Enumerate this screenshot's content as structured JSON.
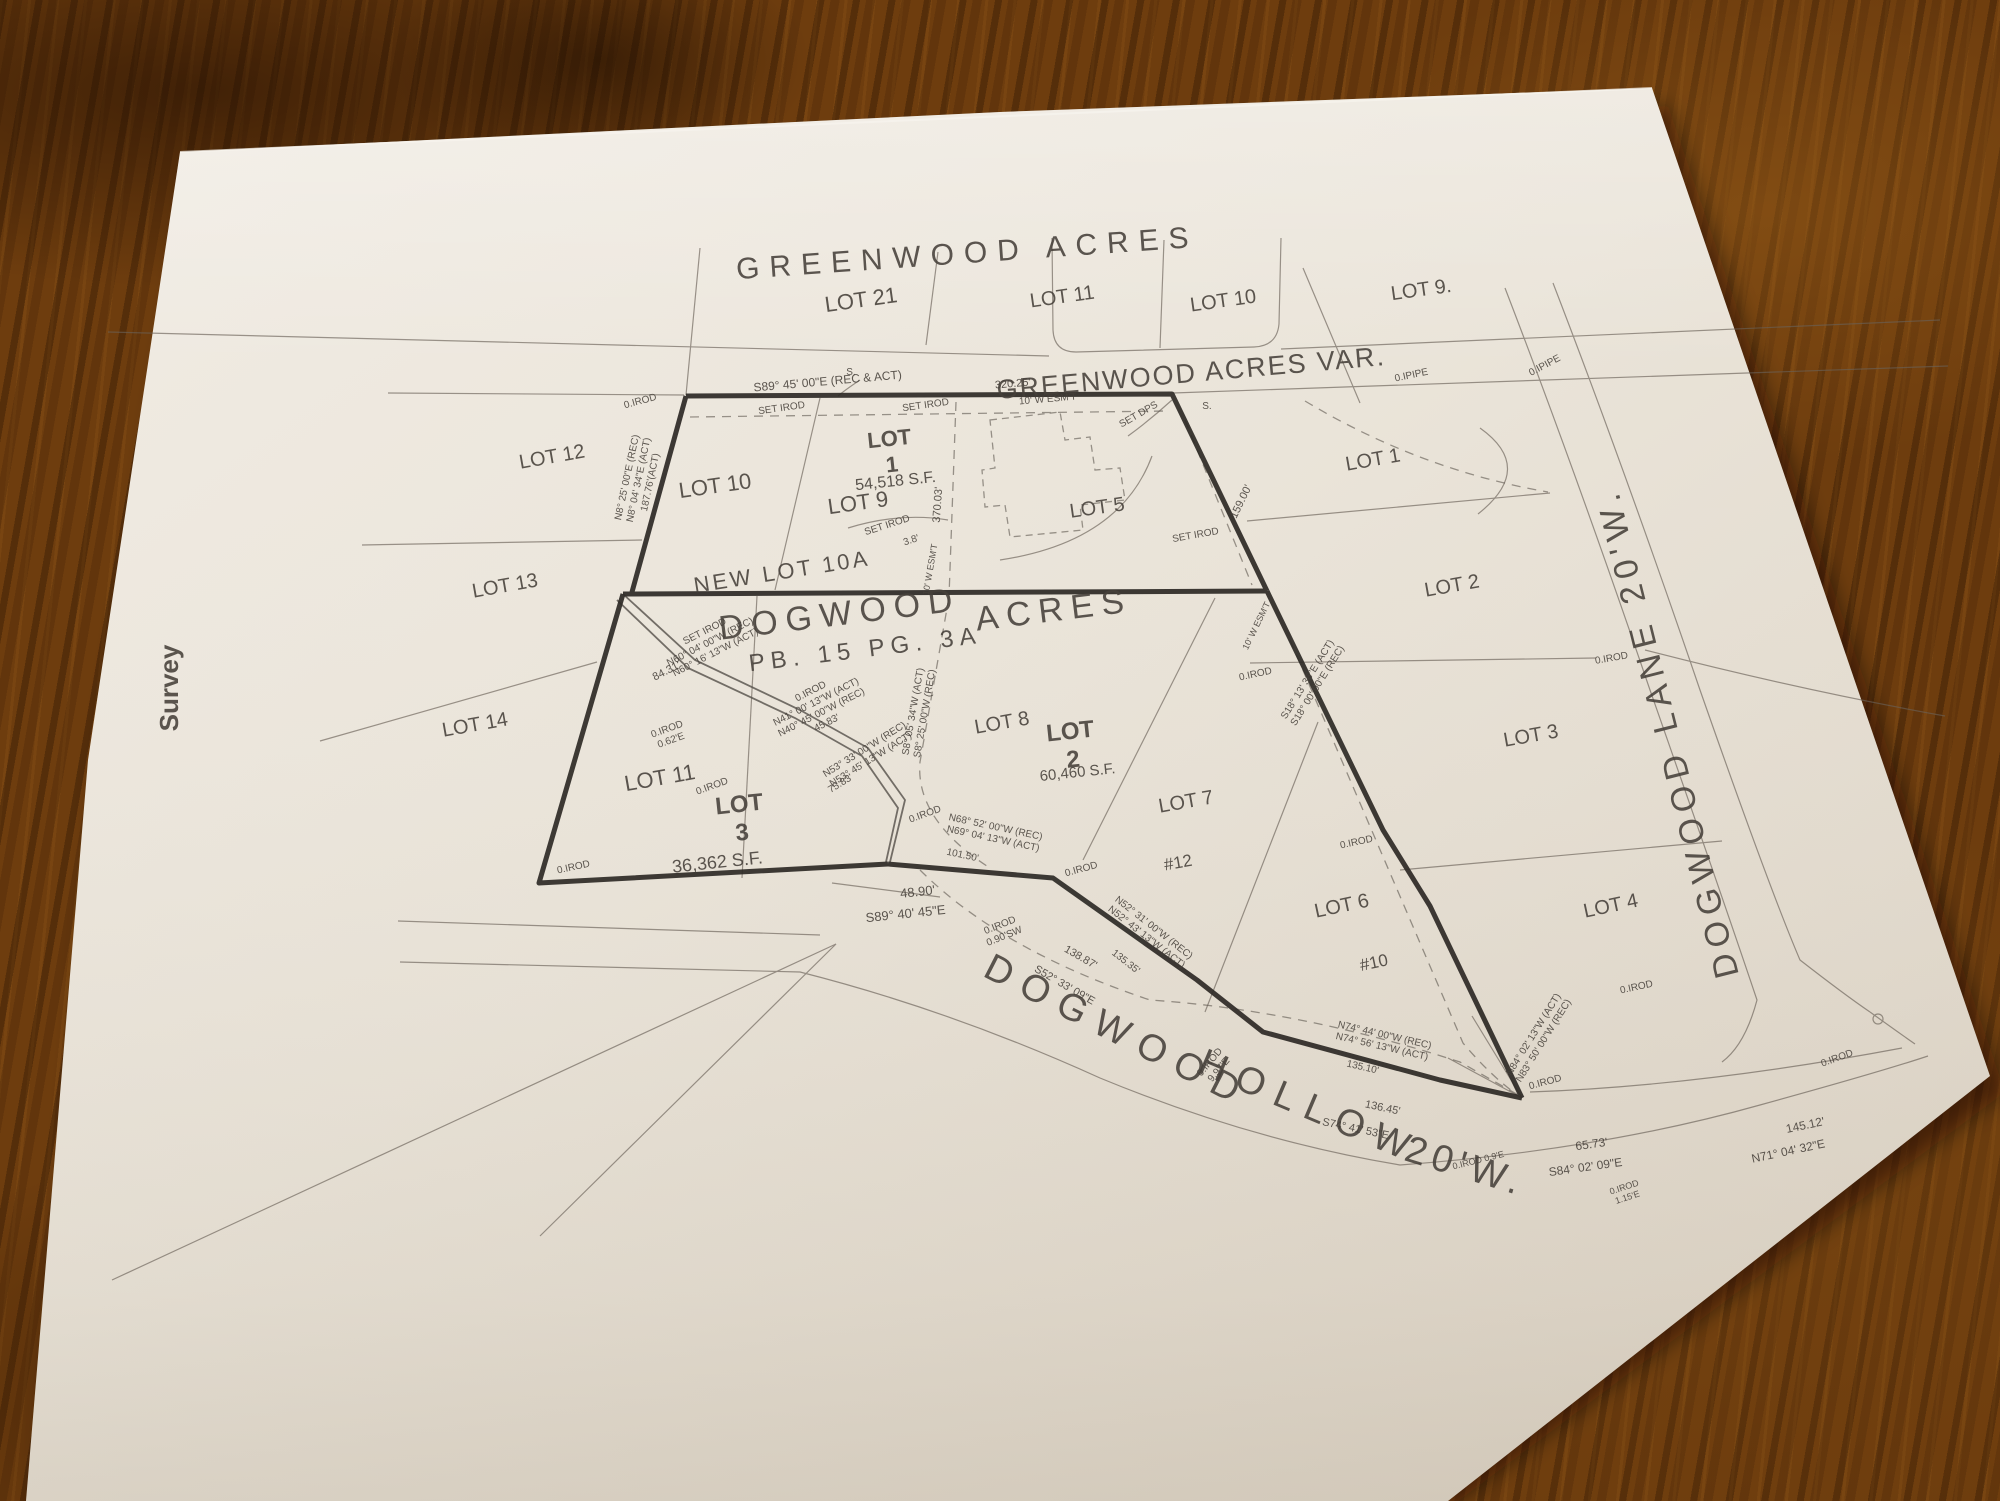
{
  "document_type": "survey plat photograph",
  "colors": {
    "paper": "#ece6db",
    "paper_shade": "#d9d1c4",
    "ink_thick": "#2e2a26",
    "ink_medium": "#55504a",
    "ink_thin": "#6a6158",
    "wood_dark": "#3f2306",
    "wood_mid": "#6e3d0e",
    "wood_light": "#93601c"
  },
  "titles": {
    "subdivision_top": "GREENWOOD ACRES",
    "subdivision_var": "GREENWOOD ACRES VAR.",
    "subdivision_main_1": "DOGWOOD",
    "subdivision_main_2": "ACRES",
    "plat_book": "PB. 15 PG. 3A",
    "sheet_tab": "Survey",
    "road_east": "DOGWOOD  LANE  20'W.",
    "road_south_1": "DOGWOOD",
    "road_south_2": "HOLLOW",
    "road_south_3": "20'W."
  },
  "labels": [
    {
      "name": "title-greenwood-acres",
      "text": "GREENWOOD   ACRES",
      "x": 968,
      "y": 263,
      "rot": -4,
      "size": 30,
      "ls": 10,
      "w": 500,
      "fill": "#3b362f"
    },
    {
      "name": "title-greenwood-var",
      "text": "GREENWOOD ACRES VAR.",
      "x": 1192,
      "y": 382,
      "rot": -5,
      "size": 27,
      "ls": 2,
      "w": 500,
      "fill": "#3b362f"
    },
    {
      "name": "title-dogwood",
      "text": "DOGWOOD",
      "x": 841,
      "y": 625,
      "rot": -7,
      "size": 34,
      "ls": 8,
      "w": 500,
      "fill": "#35302a"
    },
    {
      "name": "title-acres",
      "text": "ACRES",
      "x": 1055,
      "y": 621,
      "rot": -7,
      "size": 34,
      "ls": 8,
      "w": 500,
      "fill": "#35302a"
    },
    {
      "name": "label-plat-book",
      "text": "PB. 15 PG. 3A",
      "x": 866,
      "y": 657,
      "rot": -7,
      "size": 24,
      "ls": 6,
      "fill": "#413b33"
    },
    {
      "name": "label-new-lot-10a",
      "text": "NEW LOT 10A",
      "x": 783,
      "y": 579,
      "rot": -9,
      "size": 22,
      "ls": 3
    },
    {
      "name": "label-survey-tab",
      "text": "Survey",
      "x": 178,
      "y": 688,
      "rot": -90,
      "size": 26,
      "w": 700,
      "fill": "#1d1b18"
    },
    {
      "name": "label-dogwood-lane",
      "text": "DOGWOOD  LANE  20'W.",
      "x": 1678,
      "y": 730,
      "rot": -104,
      "size": 34,
      "ls": 7,
      "fill": "#3b362f"
    },
    {
      "name": "label-hollow-1",
      "text": "DOGWOOD",
      "x": 1112,
      "y": 1042,
      "rot": 27,
      "size": 38,
      "ls": 12,
      "fill": "#3b362f"
    },
    {
      "name": "label-hollow-2",
      "text": "HOLLOW",
      "x": 1305,
      "y": 1118,
      "rot": 23,
      "size": 38,
      "ls": 12,
      "fill": "#3b362f"
    },
    {
      "name": "label-hollow-3",
      "text": "20'W.",
      "x": 1462,
      "y": 1178,
      "rot": 17,
      "size": 38,
      "ls": 6,
      "fill": "#3b362f"
    },
    {
      "name": "label-lot-21",
      "text": "LOT 21",
      "x": 862,
      "y": 307,
      "rot": -8,
      "size": 22
    },
    {
      "name": "label-lot-11-top",
      "text": "LOT 11",
      "x": 1063,
      "y": 303,
      "rot": -8,
      "size": 20
    },
    {
      "name": "label-lot-10-top",
      "text": "LOT 10",
      "x": 1224,
      "y": 307,
      "rot": -8,
      "size": 20
    },
    {
      "name": "label-lot-9-top",
      "text": "LOT 9.",
      "x": 1422,
      "y": 296,
      "rot": -8,
      "size": 20
    },
    {
      "name": "label-lot-1-east",
      "text": "LOT 1",
      "x": 1374,
      "y": 466,
      "rot": -10,
      "size": 20
    },
    {
      "name": "label-lot-2-east",
      "text": "LOT 2",
      "x": 1453,
      "y": 592,
      "rot": -10,
      "size": 20
    },
    {
      "name": "label-lot-3-east",
      "text": "LOT 3",
      "x": 1532,
      "y": 742,
      "rot": -10,
      "size": 20
    },
    {
      "name": "label-lot-4-east",
      "text": "LOT 4",
      "x": 1612,
      "y": 912,
      "rot": -12,
      "size": 20
    },
    {
      "name": "label-lot-12",
      "text": "LOT 12",
      "x": 553,
      "y": 463,
      "rot": -10,
      "size": 20
    },
    {
      "name": "label-lot-13",
      "text": "LOT 13",
      "x": 506,
      "y": 592,
      "rot": -10,
      "size": 20
    },
    {
      "name": "label-lot-14",
      "text": "LOT 14",
      "x": 476,
      "y": 731,
      "rot": -10,
      "size": 20
    },
    {
      "name": "label-lot-10-block",
      "text": "LOT 10",
      "x": 716,
      "y": 493,
      "rot": -8,
      "size": 22
    },
    {
      "name": "label-lot-9-block",
      "text": "LOT 9",
      "x": 859,
      "y": 510,
      "rot": -8,
      "size": 22
    },
    {
      "name": "label-lot-1-stack",
      "lines": [
        "LOT",
        "1"
      ],
      "x": 890,
      "y": 446,
      "rot": -6,
      "size": 22,
      "w": 600,
      "fill": "#3b362f"
    },
    {
      "name": "label-lot-1-area",
      "text": "54,518 S.F.",
      "x": 896,
      "y": 486,
      "rot": -6,
      "size": 16
    },
    {
      "name": "label-lot-5",
      "text": "LOT 5",
      "x": 1098,
      "y": 514,
      "rot": -8,
      "size": 20
    },
    {
      "name": "label-lot-11-block",
      "text": "LOT 11",
      "x": 661,
      "y": 785,
      "rot": -10,
      "size": 22
    },
    {
      "name": "label-lot-3-stack",
      "lines": [
        "LOT",
        "3"
      ],
      "x": 740,
      "y": 812,
      "rot": -6,
      "size": 24,
      "w": 600,
      "fill": "#35302a"
    },
    {
      "name": "label-lot-3-area",
      "text": "36,362 S.F.",
      "x": 718,
      "y": 868,
      "rot": -6,
      "size": 18,
      "fill": "#3b362f"
    },
    {
      "name": "label-lot-8",
      "text": "LOT 8",
      "x": 1003,
      "y": 729,
      "rot": -10,
      "size": 20
    },
    {
      "name": "label-lot-2-stack",
      "lines": [
        "LOT",
        "2"
      ],
      "x": 1071,
      "y": 739,
      "rot": -6,
      "size": 24,
      "w": 600,
      "fill": "#35302a"
    },
    {
      "name": "label-lot-2-area",
      "text": "60,460 S.F.",
      "x": 1078,
      "y": 777,
      "rot": -6,
      "size": 15
    },
    {
      "name": "label-lot-7",
      "text": "LOT 7",
      "x": 1187,
      "y": 808,
      "rot": -10,
      "size": 20
    },
    {
      "name": "label-hash-12",
      "text": "#12",
      "x": 1179,
      "y": 868,
      "rot": -10,
      "size": 17
    },
    {
      "name": "label-lot-6",
      "text": "LOT 6",
      "x": 1343,
      "y": 912,
      "rot": -12,
      "size": 20
    },
    {
      "name": "label-hash-10",
      "text": "#10",
      "x": 1375,
      "y": 968,
      "rot": -12,
      "size": 17
    },
    {
      "name": "dim-s89-top",
      "text": "S89° 45' 00\"E (REC & ACT)",
      "x": 828,
      "y": 385,
      "rot": -5,
      "size": 12
    },
    {
      "name": "dim-320-25",
      "text": "320.25'",
      "x": 1013,
      "y": 387,
      "rot": -5,
      "size": 11
    },
    {
      "name": "dim-esmt-top",
      "text": "10' W ESM'T",
      "x": 1048,
      "y": 402,
      "rot": -5,
      "size": 10
    },
    {
      "name": "marker-set-irod-1",
      "text": "SET IROD",
      "x": 782,
      "y": 411,
      "rot": -8,
      "size": 10
    },
    {
      "name": "marker-set-irod-2",
      "text": "SET IROD",
      "x": 926,
      "y": 408,
      "rot": -8,
      "size": 10
    },
    {
      "name": "marker-set-dps",
      "text": "SET DPS",
      "x": 1140,
      "y": 417,
      "rot": -30,
      "size": 10
    },
    {
      "name": "marker-s-1",
      "text": "S.",
      "x": 851,
      "y": 375,
      "rot": 0,
      "size": 10
    },
    {
      "name": "marker-s-2",
      "text": "S.",
      "x": 1207,
      "y": 409,
      "rot": 0,
      "size": 10
    },
    {
      "name": "marker-oirod-nw",
      "text": "0.IROD",
      "x": 641,
      "y": 404,
      "rot": -15,
      "size": 10
    },
    {
      "name": "dim-n8-stack",
      "lines": [
        "N8° 25' 00\"E (REC)",
        "N8° 04' 34\"E (ACT)",
        "187.76'(ACT)"
      ],
      "x": 630,
      "y": 478,
      "rot": -78,
      "size": 10
    },
    {
      "name": "dim-370-03",
      "text": "370.03'",
      "x": 941,
      "y": 505,
      "rot": -86,
      "size": 11
    },
    {
      "name": "marker-set-irod-3",
      "text": "SET IROD",
      "x": 888,
      "y": 528,
      "rot": -18,
      "size": 10
    },
    {
      "name": "dim-3-8",
      "text": "3.8'",
      "x": 912,
      "y": 543,
      "rot": -18,
      "size": 10
    },
    {
      "name": "dim-esmt-mid",
      "text": "10' W ESM'T",
      "x": 933,
      "y": 570,
      "rot": -80,
      "size": 9
    },
    {
      "name": "dim-159-00",
      "text": "159.00'",
      "x": 1244,
      "y": 503,
      "rot": -64,
      "size": 11
    },
    {
      "name": "dim-esmt-diag",
      "text": "10' W ESM'T",
      "x": 1259,
      "y": 627,
      "rot": -64,
      "size": 9
    },
    {
      "name": "marker-set-irod-4",
      "text": "SET IROD",
      "x": 1196,
      "y": 538,
      "rot": -10,
      "size": 10
    },
    {
      "name": "marker-oipipe-1",
      "text": "0.IPIPE",
      "x": 1412,
      "y": 378,
      "rot": -12,
      "size": 10
    },
    {
      "name": "marker-oipipe-2",
      "text": "0.IPIPE",
      "x": 1546,
      "y": 368,
      "rot": -28,
      "size": 10
    },
    {
      "name": "marker-oirod-east",
      "text": "0.IROD",
      "x": 1612,
      "y": 661,
      "rot": -10,
      "size": 10
    },
    {
      "name": "dim-n60-stack",
      "lines": [
        "SET IROD",
        "N60° 04' 00\"W (REC)",
        "N60° 16' 13\"W (ACT)"
      ],
      "x": 706,
      "y": 634,
      "rot": -27,
      "size": 10
    },
    {
      "name": "dim-84-31",
      "text": "84.31'",
      "x": 668,
      "y": 674,
      "rot": -27,
      "size": 11
    },
    {
      "name": "dim-n41-stack",
      "lines": [
        "0.IROD",
        "N41° 00' 13\"W (ACT)",
        "N40° 45' 00\"W (REC)",
        "45.83'"
      ],
      "x": 812,
      "y": 694,
      "rot": -27,
      "size": 10
    },
    {
      "name": "dim-n53-stack",
      "lines": [
        "N53° 33' 00\"W (REC)",
        "N53° 45' 13\"W (ACT)"
      ],
      "x": 866,
      "y": 752,
      "rot": -32,
      "size": 10
    },
    {
      "name": "dim-75-83",
      "text": "75.83'",
      "x": 842,
      "y": 786,
      "rot": -32,
      "size": 10
    },
    {
      "name": "marker-oirod-062",
      "lines": [
        "0.IROD",
        "0.62'E"
      ],
      "x": 668,
      "y": 732,
      "rot": -20,
      "size": 10
    },
    {
      "name": "marker-oirod-lot11",
      "text": "0.IROD",
      "x": 713,
      "y": 789,
      "rot": -20,
      "size": 10
    },
    {
      "name": "marker-oirod-sw",
      "text": "0.IROD",
      "x": 574,
      "y": 870,
      "rot": -12,
      "size": 10
    },
    {
      "name": "dim-s8-stack",
      "lines": [
        "S8° 05' 34\"W (ACT)",
        "S8° 25' 00\"W (REC)"
      ],
      "x": 916,
      "y": 712,
      "rot": -80,
      "size": 10
    },
    {
      "name": "dim-s18-stack",
      "lines": [
        "S18° 13' 36\"E (ACT)",
        "S18° 00' 00\"E (REC)"
      ],
      "x": 1310,
      "y": 681,
      "rot": -58,
      "size": 10
    },
    {
      "name": "marker-oirod-cross",
      "text": "0.IROD",
      "x": 1256,
      "y": 677,
      "rot": -12,
      "size": 10
    },
    {
      "name": "dim-48-90",
      "text": "48.90'",
      "x": 918,
      "y": 896,
      "rot": -6,
      "size": 13
    },
    {
      "name": "dim-s89-40",
      "text": "S89° 40' 45\"E",
      "x": 906,
      "y": 918,
      "rot": -6,
      "size": 13
    },
    {
      "name": "marker-oirod-junc",
      "text": "0.IROD",
      "x": 1082,
      "y": 872,
      "rot": -15,
      "size": 10
    },
    {
      "name": "dim-n68-stack",
      "lines": [
        "N68° 52' 00\"W (REC)",
        "N69° 04' 13\"W (ACT)"
      ],
      "x": 995,
      "y": 830,
      "rot": 12,
      "size": 10
    },
    {
      "name": "dim-101-50",
      "text": "101.50'",
      "x": 962,
      "y": 858,
      "rot": 12,
      "size": 10
    },
    {
      "name": "marker-oirod-090",
      "lines": [
        "0.IROD",
        "0.90'SW"
      ],
      "x": 1001,
      "y": 928,
      "rot": -22,
      "size": 10
    },
    {
      "name": "dim-138-87",
      "text": "138.87'",
      "x": 1079,
      "y": 960,
      "rot": 30,
      "size": 11
    },
    {
      "name": "dim-s52",
      "text": "S52° 33' 09\"E",
      "x": 1063,
      "y": 988,
      "rot": 30,
      "size": 11
    },
    {
      "name": "dim-n52-stack",
      "lines": [
        "N52° 31' 00\"W (REC)",
        "N52° 43' 13\"W (ACT)"
      ],
      "x": 1152,
      "y": 930,
      "rot": 38,
      "size": 10
    },
    {
      "name": "dim-135-35",
      "text": "135.35'",
      "x": 1124,
      "y": 964,
      "rot": 38,
      "size": 10
    },
    {
      "name": "marker-oirod-997",
      "lines": [
        "0.IROD",
        "9.97'E"
      ],
      "x": 1212,
      "y": 1064,
      "rot": -50,
      "size": 10
    },
    {
      "name": "marker-oirod-mid",
      "text": "0.IROD",
      "x": 926,
      "y": 817,
      "rot": -20,
      "size": 10
    },
    {
      "name": "marker-oirod-1356",
      "text": "0.IROD",
      "x": 1357,
      "y": 845,
      "rot": -12,
      "size": 10
    },
    {
      "name": "dim-n74-stack",
      "lines": [
        "N74° 44' 00\"W (REC)",
        "N74° 56' 13\"W (ACT)"
      ],
      "x": 1384,
      "y": 1038,
      "rot": 13,
      "size": 10
    },
    {
      "name": "dim-135-10",
      "text": "135.10'",
      "x": 1362,
      "y": 1070,
      "rot": 13,
      "size": 10
    },
    {
      "name": "dim-136-45",
      "text": "136.45'",
      "x": 1382,
      "y": 1111,
      "rot": 12,
      "size": 11
    },
    {
      "name": "dim-s74",
      "text": "S74° 41' 53\"E",
      "x": 1355,
      "y": 1132,
      "rot": 12,
      "size": 11
    },
    {
      "name": "marker-oirod-se",
      "text": "0.IROD",
      "x": 1546,
      "y": 1085,
      "rot": -15,
      "size": 10
    },
    {
      "name": "dim-n84-stack",
      "lines": [
        "N84° 02' 13\"W (ACT)",
        "N83° 50' 00\"W (REC)"
      ],
      "x": 1536,
      "y": 1036,
      "rot": -58,
      "size": 10
    },
    {
      "name": "marker-oirod-far",
      "text": "0.IROD",
      "x": 1838,
      "y": 1061,
      "rot": -20,
      "size": 10
    },
    {
      "name": "dim-145-12",
      "text": "145.12'",
      "x": 1806,
      "y": 1129,
      "rot": -12,
      "size": 12
    },
    {
      "name": "dim-n71",
      "text": "N71° 04' 32\"E",
      "x": 1789,
      "y": 1155,
      "rot": -12,
      "size": 12
    },
    {
      "name": "dim-65-73",
      "text": "65.73'",
      "x": 1592,
      "y": 1148,
      "rot": -8,
      "size": 12
    },
    {
      "name": "dim-s84",
      "text": "S84° 02' 09\"E",
      "x": 1586,
      "y": 1171,
      "rot": -8,
      "size": 12
    },
    {
      "name": "marker-oirod-115",
      "lines": [
        "0.IROD",
        "1.15'E"
      ],
      "x": 1625,
      "y": 1190,
      "rot": -18,
      "size": 9
    },
    {
      "name": "marker-oirod-09",
      "text": "0.IROD 0.9'E",
      "x": 1479,
      "y": 1163,
      "rot": -14,
      "size": 9
    },
    {
      "name": "marker-oirod-lot4",
      "text": "0.IROD",
      "x": 1637,
      "y": 990,
      "rot": -12,
      "size": 10
    }
  ]
}
